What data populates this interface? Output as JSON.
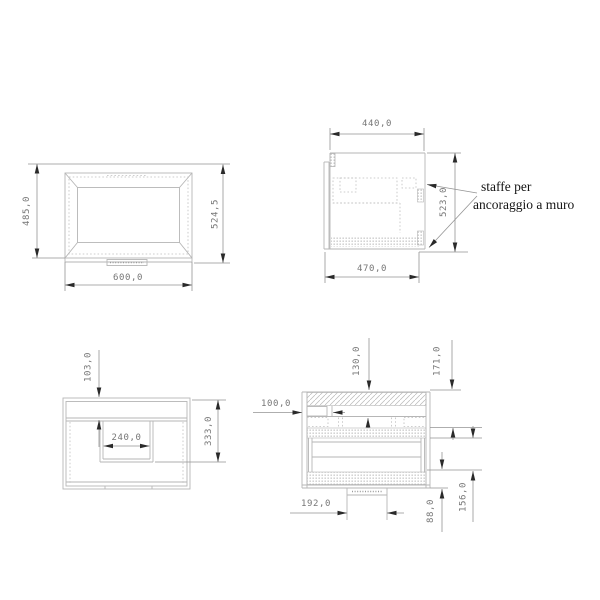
{
  "colors": {
    "background": "#ffffff",
    "geometry_line": "#b6b6b6",
    "dimension_line": "#939393",
    "arrow": "#2a2a2a",
    "dimension_text": "#767676",
    "note_text": "#151515"
  },
  "views": {
    "basin_front": {
      "dims": {
        "height_left": "485,0",
        "height_overall": "524,5",
        "width": "600,0"
      }
    },
    "side": {
      "dims": {
        "depth_top": "440,0",
        "height": "523,0",
        "depth_bottom": "470,0"
      },
      "note": {
        "line1": "staffe per",
        "line2": "ancoraggio a muro"
      }
    },
    "cabinet_front": {
      "dims": {
        "top_band": "103,0",
        "recess_width": "240,0",
        "height_to_recess": "333,0"
      }
    },
    "cabinet_section": {
      "dims": {
        "top_depth": "130,0",
        "top_total": "171,0",
        "bracket_inset": "100,0",
        "trap_width": "192,0",
        "plinth_height": "88,0",
        "bottom_height": "156,0"
      }
    }
  }
}
